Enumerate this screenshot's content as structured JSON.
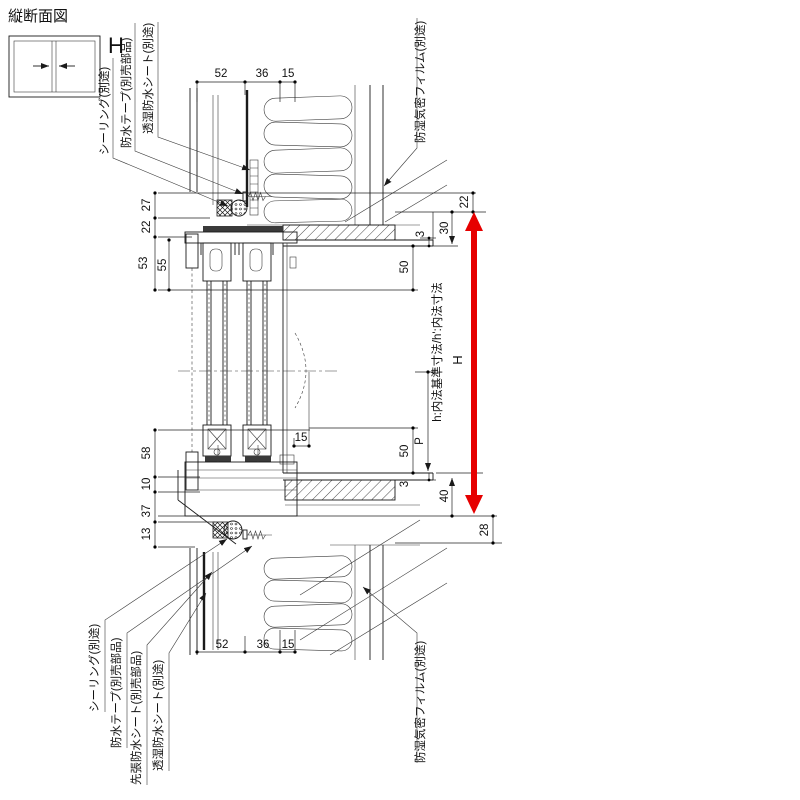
{
  "title": "縦断面図",
  "icon": {
    "label": "H"
  },
  "callouts": {
    "top_left": [
      "シーリング(別途)",
      "防水テープ(別売部品)",
      "透湿防水シート(別途)"
    ],
    "top_right": "防湿気密フィルム(別途)",
    "bottom_left": [
      "シーリング(別途)",
      "防水テープ(別売部品)",
      "先張防水シート(別売部品)",
      "透湿防水シート(別途)"
    ],
    "bottom_right": "防湿気密フィルム(別途)"
  },
  "dims": {
    "top": [
      "52",
      "36",
      "15"
    ],
    "bottom": [
      "52",
      "36",
      "15"
    ],
    "left_upper": [
      "27",
      "22",
      "53",
      "55"
    ],
    "left_lower": [
      "58",
      "10",
      "37",
      "13"
    ],
    "right_upper": [
      "22",
      "30",
      "3",
      "50"
    ],
    "right_lower": [
      "P",
      "50",
      "3",
      "40",
      "28"
    ],
    "inner15": "15",
    "arrow_label": "H",
    "note": "h:内法基準寸法/h':内法寸法"
  },
  "colors": {
    "line": "#1a1a1a",
    "accent_red": "#e60000"
  }
}
